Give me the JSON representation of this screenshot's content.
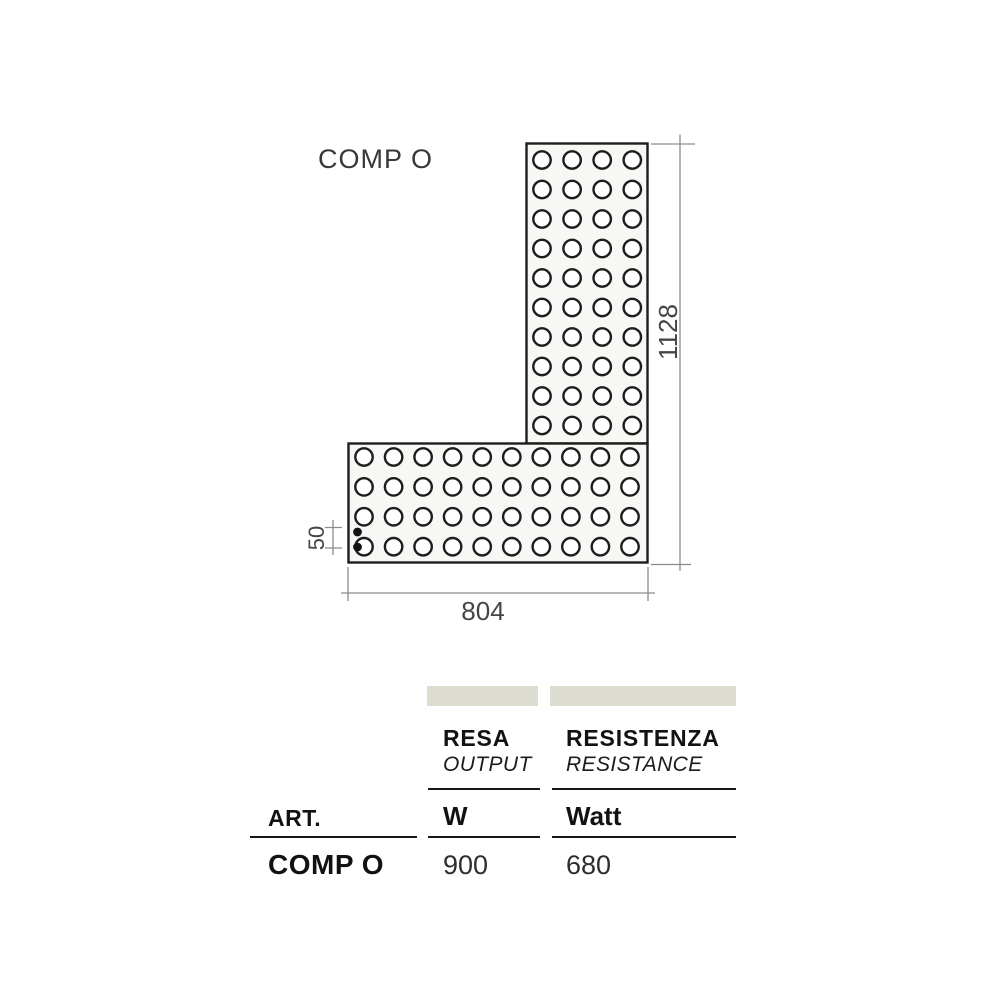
{
  "diagram": {
    "title": "COMP O",
    "dim_height_label": "1128",
    "dim_width_label": "804",
    "dim_inlet_label": "50",
    "vertical_grid": {
      "cols": 4,
      "rows": 10
    },
    "horizontal_grid": {
      "cols": 10,
      "rows": 4
    }
  },
  "table": {
    "art_header": "ART.",
    "col_resa": {
      "name": "RESA",
      "translation": "OUTPUT",
      "unit": "W"
    },
    "col_resistenza": {
      "name": "RESISTENZA",
      "translation": "RESISTANCE",
      "unit": "Watt"
    },
    "row": {
      "art": "COMP O",
      "resa_value": "900",
      "resistenza_value": "680"
    }
  },
  "colors": {
    "outline": "#1d1d1b",
    "body_fill": "#f7f7f6",
    "dimension_line": "#8c8c8c",
    "dimension_text": "#454545",
    "header_bar": "#dcdcd1",
    "table_text": "#121212"
  }
}
